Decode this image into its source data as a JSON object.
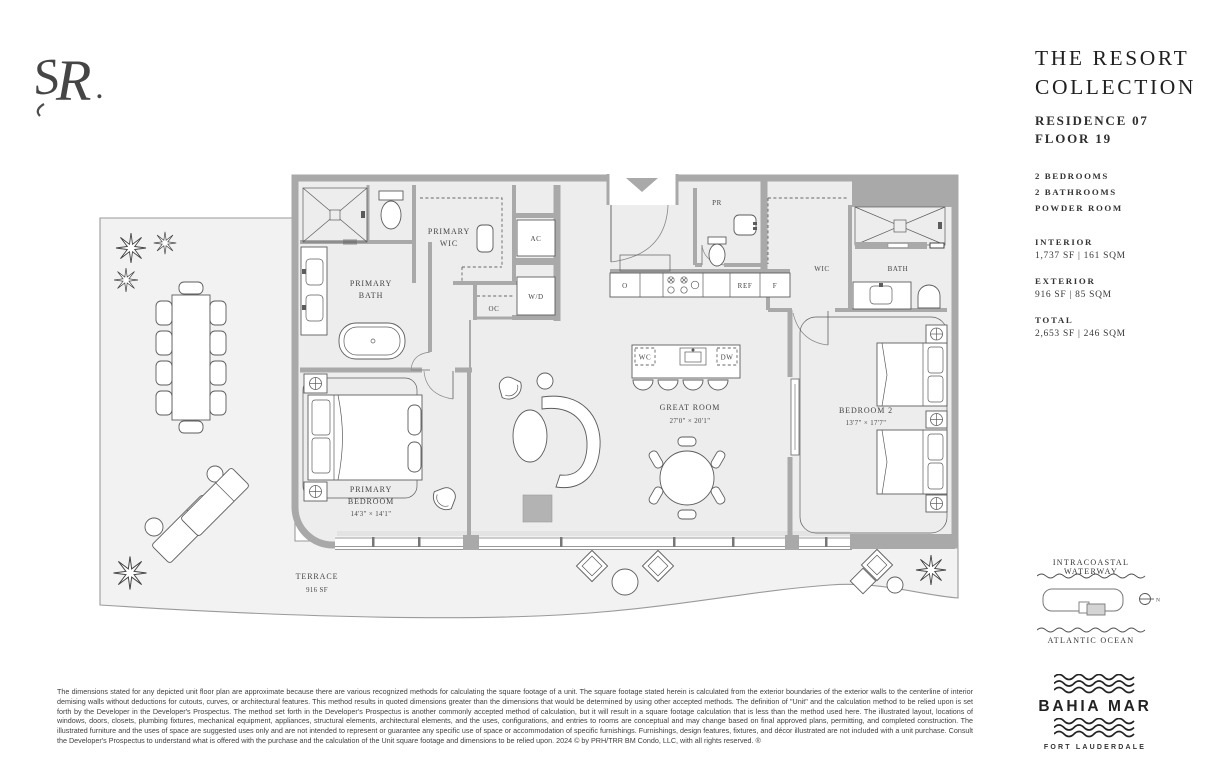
{
  "panel": {
    "title_line1": "THE RESORT",
    "title_line2": "COLLECTION",
    "residence": "RESIDENCE 07",
    "floor": "FLOOR 19",
    "features": [
      "2 BEDROOMS",
      "2 BATHROOMS",
      "POWDER ROOM"
    ],
    "areas": [
      {
        "label": "INTERIOR",
        "value": "1,737 SF | 161 SQM"
      },
      {
        "label": "EXTERIOR",
        "value": "916 SF | 85 SQM"
      },
      {
        "label": "TOTAL",
        "value": "2,653 SF | 246 SQM"
      }
    ]
  },
  "locator": {
    "waterway": "INTRACOASTAL WATERWAY",
    "ocean": "ATLANTIC OCEAN",
    "north": "N"
  },
  "brand": {
    "monogram": "R",
    "name": "BAHIA MAR",
    "city": "FORT LAUDERDALE"
  },
  "plan": {
    "primary_bath_1": "PRIMARY",
    "primary_bath_2": "BATH",
    "primary_wic_1": "PRIMARY",
    "primary_wic_2": "WIC",
    "ac": "AC",
    "wd": "W/D",
    "oc": "OC",
    "pr": "PR",
    "oven": "O",
    "ref": "REF",
    "freezer": "F",
    "wine": "WC",
    "dw": "DW",
    "great_room": "GREAT ROOM",
    "great_room_dims": "27'0\" × 20'1\"",
    "wic2": "WIC",
    "bath2": "BATH",
    "bedroom2": "BEDROOM 2",
    "bedroom2_dims": "13'7\" × 17'7\"",
    "primary_bedroom_1": "PRIMARY",
    "primary_bedroom_2": "BEDROOM",
    "primary_bedroom_dims": "14'3\" × 14'1\"",
    "terrace": "TERRACE",
    "terrace_area": "916 SF"
  },
  "disclaimer": "The dimensions stated for any depicted unit floor plan are approximate because there are various recognized methods for calculating the square footage of a unit. The square footage stated herein is calculated from the exterior boundaries of the exterior walls to the centerline of interior demising walls without deductions for cutouts, curves, or architectural features. This method results in quoted dimensions greater than the dimensions that would be determined by using other accepted methods. The definition of \"Unit\" and the calculation method to be relied upon is set forth by the Developer in the Developer's Prospectus. The method set forth in the Developer's Prospectus is another commonly accepted method of calculation, but it will result in a square footage calculation that is less than the method used here. The illustrated layout, locations of windows, doors, closets, plumbing fixtures, mechanical equipment, appliances, structural elements, architectural elements, and the uses, configurations, and entries to rooms are conceptual and may change based on final approved plans, permitting, and completed construction. The illustrated furniture and the uses of space are suggested uses only and are not intended to represent or guarantee any specific use of space or accommodation of specific furnishings. Furnishings, design features, fixtures, and décor illustrated are not included with a unit purchase. Consult the Developer's Prospectus to understand what is offered with the purchase and the calculation of the Unit square footage and dimensions to be relied upon. 2024 © by PRH/TRR BM Condo, LLC, with all rights reserved. ®"
}
